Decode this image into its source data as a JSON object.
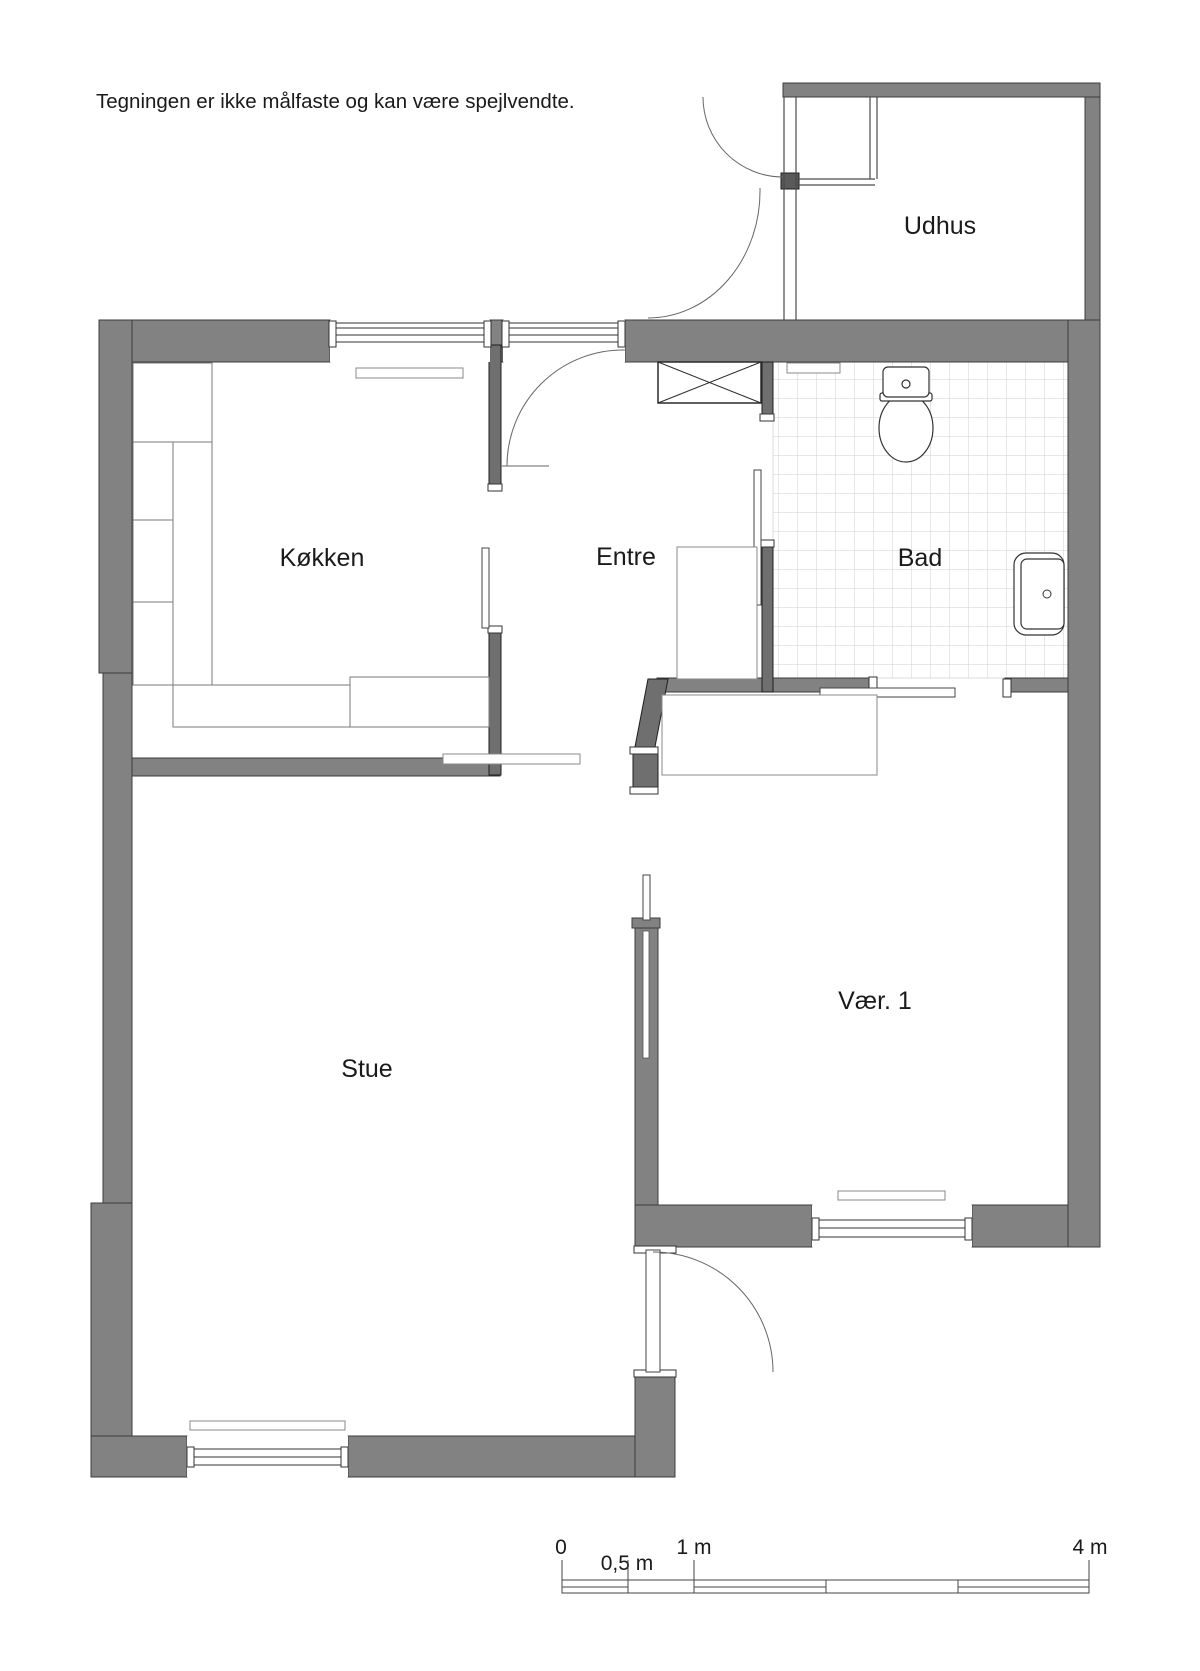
{
  "disclaimer": "Tegningen er ikke målfaste og kan være spejlvendte.",
  "rooms": [
    {
      "name": "udhus",
      "label": "Udhus"
    },
    {
      "name": "kokken",
      "label": "Køkken"
    },
    {
      "name": "entre",
      "label": "Entre"
    },
    {
      "name": "bad",
      "label": "Bad"
    },
    {
      "name": "stue",
      "label": "Stue"
    },
    {
      "name": "vaer1",
      "label": "Vær. 1"
    }
  ],
  "scale_bar": {
    "labels": [
      "0",
      "0,5 m",
      "1 m",
      "4 m"
    ]
  },
  "icons": {
    "toilet": "toilet-icon",
    "sink": "sink-icon",
    "wardrobe_cross": "crossed-box-icon"
  },
  "colors": {
    "wall": "#828282",
    "wall_dark": "#6f6f6f",
    "outline": "#333333",
    "tile_line": "#cfcfcf",
    "furniture_line": "#8a8a8a",
    "text": "#1a1a1a"
  }
}
